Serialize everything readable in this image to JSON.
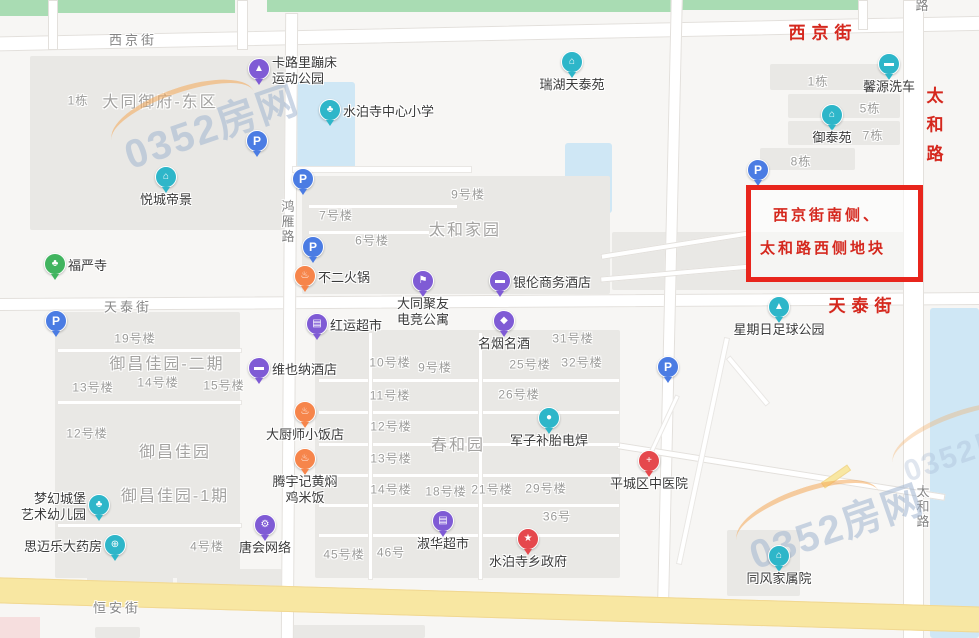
{
  "watermark": {
    "text": "0352房网"
  },
  "annotation": {
    "line1": "西京街南侧、",
    "line2": "太和路西侧地块",
    "box": {
      "x": 746,
      "y": 185,
      "w": 167,
      "h": 87
    },
    "border_color": "#e8251c",
    "text_color": "#d5281e"
  },
  "colors": {
    "purple": "#7f5bd5",
    "teal": "#2eb6c9",
    "green": "#41b45f",
    "orange": "#f6854b",
    "red": "#e5484d",
    "blue": "#4b7ce3",
    "road_yellow": "#f8e7a2",
    "park_green": "#a9dcb3",
    "water_blue": "#cfe7f5"
  },
  "streets_gray": [
    {
      "t": "西京街",
      "x": 133,
      "y": 39,
      "vert": false
    },
    {
      "t": "路",
      "x": 921,
      "y": 6,
      "vert": true
    },
    {
      "t": "鸿雁路",
      "x": 287,
      "y": 222,
      "vert": true
    },
    {
      "t": "天泰街",
      "x": 128,
      "y": 306,
      "vert": false
    },
    {
      "t": "恒安街",
      "x": 117,
      "y": 607,
      "vert": false
    },
    {
      "t": "太和路",
      "x": 922,
      "y": 507,
      "vert": true
    }
  ],
  "streets_red": [
    {
      "t": "西京街",
      "x": 823,
      "y": 31,
      "vert": false
    },
    {
      "t": "太和路",
      "x": 933,
      "y": 130,
      "vert": true
    },
    {
      "t": "天泰街",
      "x": 863,
      "y": 304,
      "vert": false
    }
  ],
  "areas": [
    {
      "t": "大同御府-东区",
      "x": 160,
      "y": 100
    },
    {
      "t": "太和家园",
      "x": 465,
      "y": 228
    },
    {
      "t": "御昌佳园-二期",
      "x": 167,
      "y": 362
    },
    {
      "t": "御昌佳园",
      "x": 175,
      "y": 450
    },
    {
      "t": "御昌佳园-1期",
      "x": 175,
      "y": 494
    },
    {
      "t": "春和园",
      "x": 458,
      "y": 443
    }
  ],
  "buildings": [
    {
      "t": "1栋",
      "x": 78,
      "y": 100
    },
    {
      "t": "9号楼",
      "x": 468,
      "y": 194
    },
    {
      "t": "7号楼",
      "x": 336,
      "y": 215
    },
    {
      "t": "6号楼",
      "x": 372,
      "y": 240
    },
    {
      "t": "1栋",
      "x": 818,
      "y": 81
    },
    {
      "t": "5栋",
      "x": 870,
      "y": 108
    },
    {
      "t": "7栋",
      "x": 873,
      "y": 135
    },
    {
      "t": "8栋",
      "x": 801,
      "y": 161
    },
    {
      "t": "19号楼",
      "x": 135,
      "y": 338
    },
    {
      "t": "13号楼",
      "x": 93,
      "y": 387
    },
    {
      "t": "14号楼",
      "x": 158,
      "y": 382
    },
    {
      "t": "15号楼",
      "x": 224,
      "y": 385
    },
    {
      "t": "12号楼",
      "x": 87,
      "y": 433
    },
    {
      "t": "4号楼",
      "x": 207,
      "y": 546
    },
    {
      "t": "31号楼",
      "x": 573,
      "y": 338
    },
    {
      "t": "10号楼",
      "x": 390,
      "y": 362
    },
    {
      "t": "9号楼",
      "x": 435,
      "y": 367
    },
    {
      "t": "25号楼",
      "x": 530,
      "y": 364
    },
    {
      "t": "32号楼",
      "x": 582,
      "y": 362
    },
    {
      "t": "11号楼",
      "x": 390,
      "y": 395
    },
    {
      "t": "26号楼",
      "x": 519,
      "y": 394
    },
    {
      "t": "12号楼",
      "x": 391,
      "y": 426
    },
    {
      "t": "13号楼",
      "x": 391,
      "y": 458
    },
    {
      "t": "14号楼",
      "x": 391,
      "y": 489
    },
    {
      "t": "18号楼",
      "x": 446,
      "y": 491
    },
    {
      "t": "21号楼",
      "x": 492,
      "y": 489
    },
    {
      "t": "29号楼",
      "x": 546,
      "y": 488
    },
    {
      "t": "36号",
      "x": 557,
      "y": 516
    },
    {
      "t": "45号楼",
      "x": 344,
      "y": 554
    },
    {
      "t": "46号",
      "x": 391,
      "y": 552
    }
  ],
  "pois": [
    {
      "name": "卡路里蹦床运动公园",
      "icon": "trampoline-park-icon",
      "color": "purple",
      "x": 259,
      "y": 71,
      "lines": [
        "卡路里蹦床",
        "运动公园"
      ],
      "pos": "right",
      "glyph": "▲"
    },
    {
      "name": "水泊寺中心小学",
      "icon": "school-icon",
      "color": "teal",
      "x": 330,
      "y": 112,
      "lines": [
        "水泊寺中心小学"
      ],
      "pos": "right",
      "glyph": "♣"
    },
    {
      "name": "瑞湖天泰苑",
      "icon": "residence-icon",
      "color": "teal",
      "x": 572,
      "y": 64,
      "lines": [
        "瑞湖天泰苑"
      ],
      "pos": "below",
      "glyph": "⌂"
    },
    {
      "name": "馨源洗车",
      "icon": "car-wash-icon",
      "color": "teal",
      "x": 889,
      "y": 66,
      "lines": [
        "馨源洗车"
      ],
      "pos": "below",
      "glyph": "▬"
    },
    {
      "name": "御泰苑",
      "icon": "residence-icon",
      "color": "teal",
      "x": 832,
      "y": 117,
      "lines": [
        "御泰苑"
      ],
      "pos": "below",
      "glyph": "⌂"
    },
    {
      "name": "悦城帝景",
      "icon": "residence-icon",
      "color": "teal",
      "x": 166,
      "y": 179,
      "lines": [
        "悦城帝景"
      ],
      "pos": "below",
      "glyph": "⌂"
    },
    {
      "name": "福严寺",
      "icon": "temple-icon",
      "color": "green",
      "x": 55,
      "y": 266,
      "lines": [
        "福严寺"
      ],
      "pos": "right",
      "glyph": "♣"
    },
    {
      "name": "不二火锅",
      "icon": "restaurant-icon",
      "color": "orange",
      "x": 305,
      "y": 278,
      "lines": [
        "不二火锅"
      ],
      "pos": "right",
      "glyph": "♨"
    },
    {
      "name": "银伦商务酒店",
      "icon": "hotel-icon",
      "color": "purple",
      "x": 500,
      "y": 283,
      "lines": [
        "银伦商务酒店"
      ],
      "pos": "right",
      "glyph": "▬"
    },
    {
      "name": "大同聚友电竞公寓",
      "icon": "apartment-flag-icon",
      "color": "purple",
      "x": 423,
      "y": 283,
      "lines": [
        "大同聚友",
        "电竞公寓"
      ],
      "pos": "below",
      "glyph": "⚑"
    },
    {
      "name": "红运超市",
      "icon": "supermarket-icon",
      "color": "purple",
      "x": 317,
      "y": 326,
      "lines": [
        "红运超市"
      ],
      "pos": "right",
      "glyph": "▤"
    },
    {
      "name": "名烟名酒",
      "icon": "shop-bag-icon",
      "color": "purple",
      "x": 504,
      "y": 323,
      "lines": [
        "名烟名酒"
      ],
      "pos": "below",
      "glyph": "◆"
    },
    {
      "name": "维也纳酒店",
      "icon": "hotel-icon",
      "color": "purple",
      "x": 259,
      "y": 370,
      "lines": [
        "维也纳酒店"
      ],
      "pos": "right",
      "glyph": "▬"
    },
    {
      "name": "星期日足球公园",
      "icon": "sports-park-icon",
      "color": "teal",
      "x": 779,
      "y": 309,
      "lines": [
        "星期日足球公园"
      ],
      "pos": "below",
      "glyph": "▲"
    },
    {
      "name": "大厨师小饭店",
      "icon": "restaurant-icon",
      "color": "orange",
      "x": 305,
      "y": 414,
      "lines": [
        "大厨师小饭店"
      ],
      "pos": "below",
      "glyph": "♨"
    },
    {
      "name": "军子补胎电焊",
      "icon": "tire-repair-icon",
      "color": "teal",
      "x": 549,
      "y": 420,
      "lines": [
        "军子补胎电焊"
      ],
      "pos": "below",
      "glyph": "●"
    },
    {
      "name": "腾宇记黄焖鸡米饭",
      "icon": "restaurant-icon",
      "color": "orange",
      "x": 305,
      "y": 461,
      "lines": [
        "腾宇记黄焖",
        "鸡米饭"
      ],
      "pos": "below",
      "glyph": "♨"
    },
    {
      "name": "梦幻城堡艺术幼儿园",
      "icon": "kindergarten-icon",
      "color": "teal",
      "x": 99,
      "y": 507,
      "lines": [
        "梦幻城堡",
        "艺术幼儿园"
      ],
      "pos": "left",
      "glyph": "♣"
    },
    {
      "name": "思迈乐大药房",
      "icon": "pharmacy-icon",
      "color": "teal",
      "x": 115,
      "y": 547,
      "lines": [
        "思迈乐大药房"
      ],
      "pos": "left",
      "glyph": "⊕"
    },
    {
      "name": "唐会网络",
      "icon": "internet-cafe-icon",
      "color": "purple",
      "x": 265,
      "y": 527,
      "lines": [
        "唐会网络"
      ],
      "pos": "below",
      "glyph": "⚙"
    },
    {
      "name": "淑华超市",
      "icon": "supermarket-icon",
      "color": "purple",
      "x": 443,
      "y": 523,
      "lines": [
        "淑华超市"
      ],
      "pos": "below",
      "glyph": "▤"
    },
    {
      "name": "水泊寺乡政府",
      "icon": "government-icon",
      "color": "red",
      "x": 528,
      "y": 541,
      "lines": [
        "水泊寺乡政府"
      ],
      "pos": "below",
      "glyph": "★"
    },
    {
      "name": "平城区中医院",
      "icon": "hospital-icon",
      "color": "red",
      "x": 649,
      "y": 463,
      "lines": [
        "平城区中医院"
      ],
      "pos": "below",
      "glyph": "+"
    },
    {
      "name": "同风家属院",
      "icon": "residence-icon",
      "color": "teal",
      "x": 779,
      "y": 558,
      "lines": [
        "同风家属院"
      ],
      "pos": "below",
      "glyph": "⌂"
    }
  ],
  "parkings": [
    {
      "x": 257,
      "y": 142
    },
    {
      "x": 303,
      "y": 180
    },
    {
      "x": 313,
      "y": 248
    },
    {
      "x": 56,
      "y": 322
    },
    {
      "x": 668,
      "y": 368
    },
    {
      "x": 758,
      "y": 171
    }
  ],
  "watermarks": [
    {
      "x": 120,
      "y": 95,
      "small": false
    },
    {
      "x": 745,
      "y": 495,
      "small": false
    },
    {
      "x": 900,
      "y": 425,
      "small": true
    }
  ],
  "shapes": {
    "green": [
      [
        0,
        0,
        50,
        16
      ],
      [
        58,
        0,
        177,
        13
      ],
      [
        267,
        0,
        405,
        12
      ],
      [
        682,
        0,
        176,
        10
      ]
    ],
    "water": [
      [
        293,
        82,
        62,
        88
      ],
      [
        565,
        143,
        47,
        70
      ],
      [
        930,
        308,
        49,
        330
      ]
    ],
    "block": [
      [
        30,
        56,
        257,
        174
      ],
      [
        302,
        176,
        308,
        118
      ],
      [
        612,
        232,
        296,
        58
      ],
      [
        55,
        312,
        185,
        266
      ],
      [
        315,
        330,
        305,
        248
      ],
      [
        727,
        530,
        73,
        66
      ],
      [
        770,
        64,
        118,
        26
      ],
      [
        788,
        94,
        112,
        24
      ],
      [
        788,
        121,
        112,
        24
      ],
      [
        760,
        148,
        95,
        22
      ],
      [
        87,
        560,
        86,
        28
      ],
      [
        177,
        566,
        60,
        19
      ],
      [
        237,
        569,
        45,
        18
      ],
      [
        95,
        627,
        45,
        11
      ],
      [
        290,
        625,
        135,
        13
      ]
    ],
    "pink": [
      [
        0,
        617,
        40,
        21
      ]
    ],
    "road": [
      [
        -8,
        26,
        1000,
        13,
        -1.2
      ],
      [
        -8,
        295,
        1000,
        11,
        -0.35
      ],
      [
        283,
        13,
        11,
        625,
        0.4
      ],
      [
        664,
        -5,
        10,
        605,
        1.3
      ],
      [
        903,
        0,
        19,
        638,
        0
      ],
      [
        48,
        0,
        8,
        48,
        0
      ],
      [
        237,
        0,
        9,
        48,
        0
      ],
      [
        858,
        0,
        8,
        28,
        0
      ],
      [
        615,
        468,
        330,
        5,
        9
      ],
      [
        600,
        242,
        150,
        4,
        -9
      ],
      [
        600,
        270,
        150,
        4,
        -5
      ]
    ],
    "path": [
      [
        292,
        166,
        178,
        5,
        0
      ],
      [
        308,
        204,
        148,
        3,
        0
      ],
      [
        308,
        230,
        120,
        3,
        0
      ],
      [
        57,
        348,
        183,
        3,
        0
      ],
      [
        57,
        400,
        183,
        3,
        0
      ],
      [
        57,
        523,
        183,
        3,
        0
      ],
      [
        318,
        378,
        300,
        3,
        0
      ],
      [
        318,
        410,
        300,
        3,
        0
      ],
      [
        318,
        442,
        300,
        3,
        0
      ],
      [
        318,
        473,
        300,
        3,
        0
      ],
      [
        318,
        503,
        300,
        3,
        0
      ],
      [
        318,
        533,
        300,
        3,
        0
      ],
      [
        368,
        332,
        3,
        246,
        0
      ],
      [
        478,
        332,
        3,
        246,
        0
      ],
      [
        700,
        335,
        4,
        230,
        12
      ],
      [
        745,
        350,
        4,
        60,
        -40
      ],
      [
        660,
        392,
        3,
        70,
        25
      ]
    ],
    "yellow": [
      [
        -10,
        592,
        1000,
        24,
        1.7
      ],
      [
        820,
        473,
        30,
        5,
        -35
      ]
    ]
  }
}
